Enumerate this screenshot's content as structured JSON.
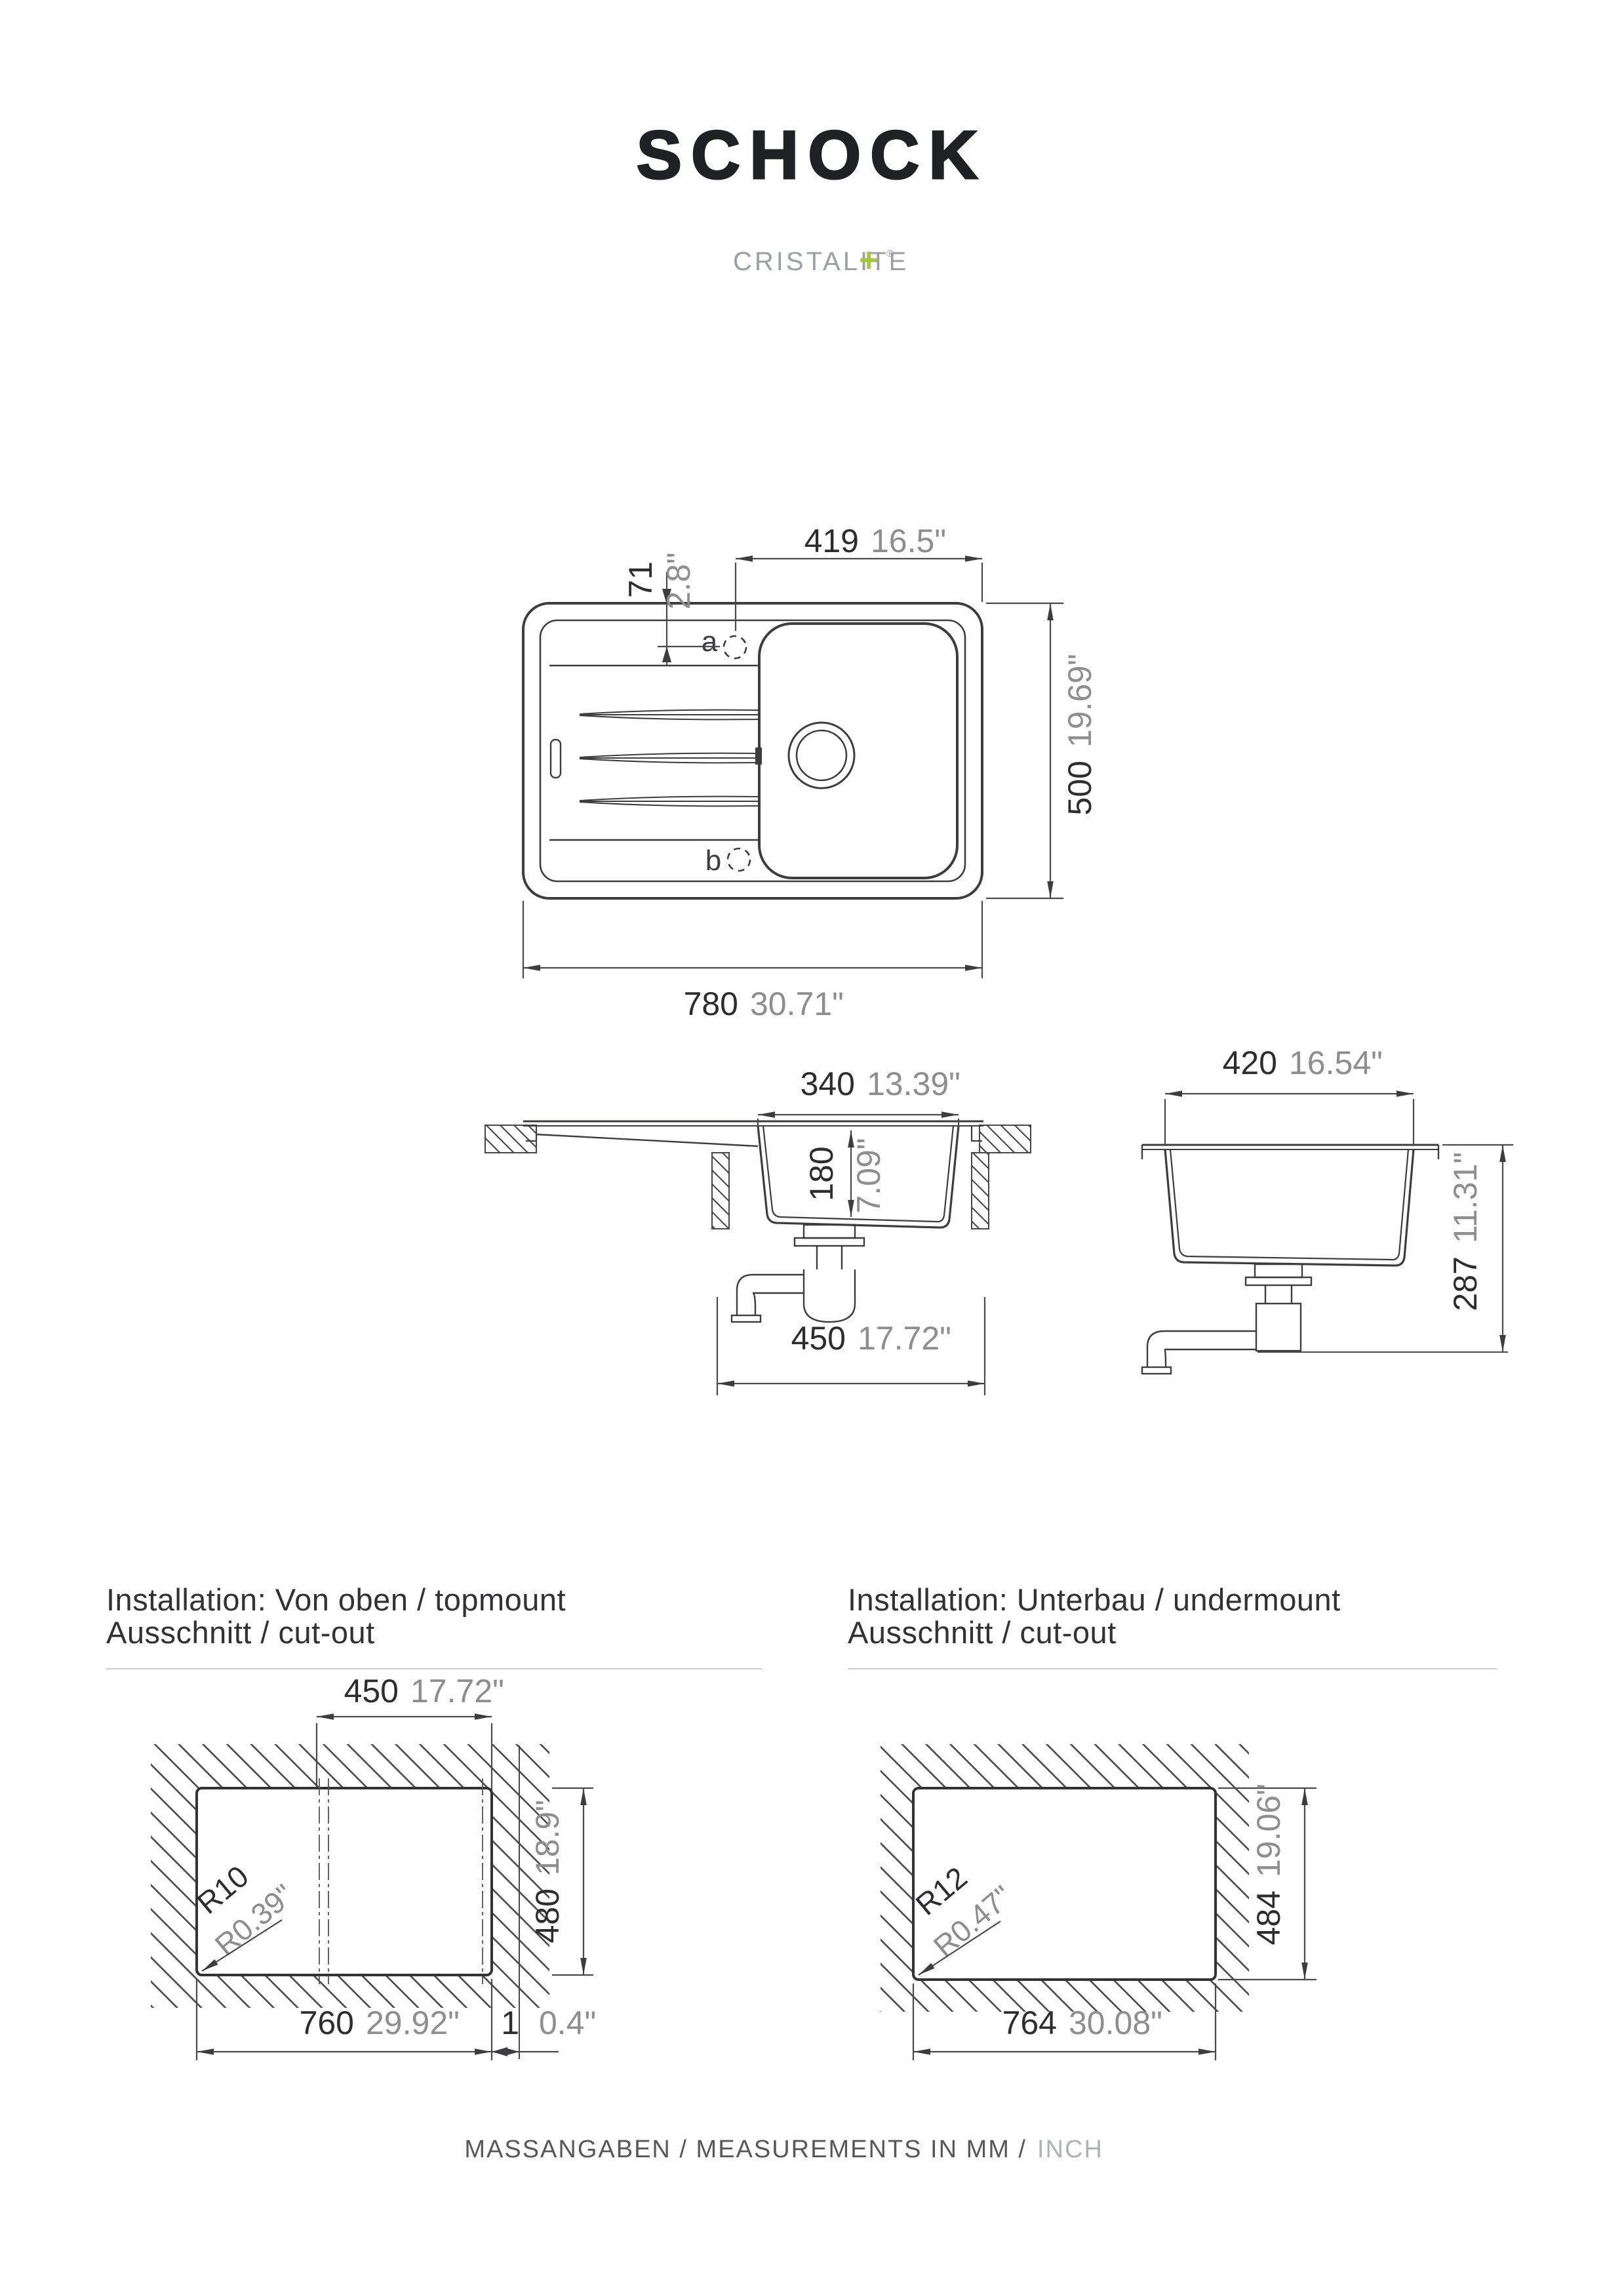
{
  "brand": {
    "logo": "SCHOCK",
    "material": "CRISTALITE",
    "material_plus": "+",
    "registered": "®"
  },
  "top_view": {
    "hole_a": "a",
    "hole_b": "b",
    "dim_width_to_hole": {
      "mm": "419",
      "inch": "16.5\""
    },
    "dim_hole_offset": {
      "mm": "71",
      "inch": "2.8\""
    },
    "dim_depth": {
      "mm": "500",
      "inch": "19.69\""
    },
    "dim_length": {
      "mm": "780",
      "inch": "30.71\""
    }
  },
  "front_section": {
    "dim_bowl_length": {
      "mm": "340",
      "inch": "13.39\""
    },
    "dim_bowl_depth": {
      "mm": "180",
      "inch": "7.09\""
    },
    "dim_cabinet": {
      "mm": "450",
      "inch": "17.72\""
    }
  },
  "cross_section": {
    "dim_bowl_width": {
      "mm": "420",
      "inch": "16.54\""
    },
    "dim_total_depth": {
      "mm": "287",
      "inch": "11.31\""
    }
  },
  "topmount": {
    "title_line1": "Installation: Von oben / topmount",
    "title_line2": "Ausschnitt / cut-out",
    "dim_center": {
      "mm": "450",
      "inch": "17.72\""
    },
    "dim_height": {
      "mm": "480",
      "inch": "18.9\""
    },
    "dim_width": {
      "mm": "760",
      "inch": "29.92\""
    },
    "dim_edge": {
      "mm": "1",
      "inch": "0.4\""
    },
    "radius": {
      "mm": "R10",
      "inch": "R0.39\""
    }
  },
  "undermount": {
    "title_line1": "Installation: Unterbau / undermount",
    "title_line2": "Ausschnitt / cut-out",
    "dim_height": {
      "mm": "484",
      "inch": "19.06\""
    },
    "dim_width": {
      "mm": "764",
      "inch": "30.08\""
    },
    "radius": {
      "mm": "R12",
      "inch": "R0.47\""
    }
  },
  "footer": {
    "text_primary": "MASSANGABEN / MEASUREMENTS IN MM /",
    "text_secondary": "INCH"
  },
  "colors": {
    "accent_green": "#a5c73d",
    "drawing_line": "#3d3d40",
    "dim_mm_text": "#2d2d2f",
    "dim_inch_text": "#8e8e90"
  }
}
